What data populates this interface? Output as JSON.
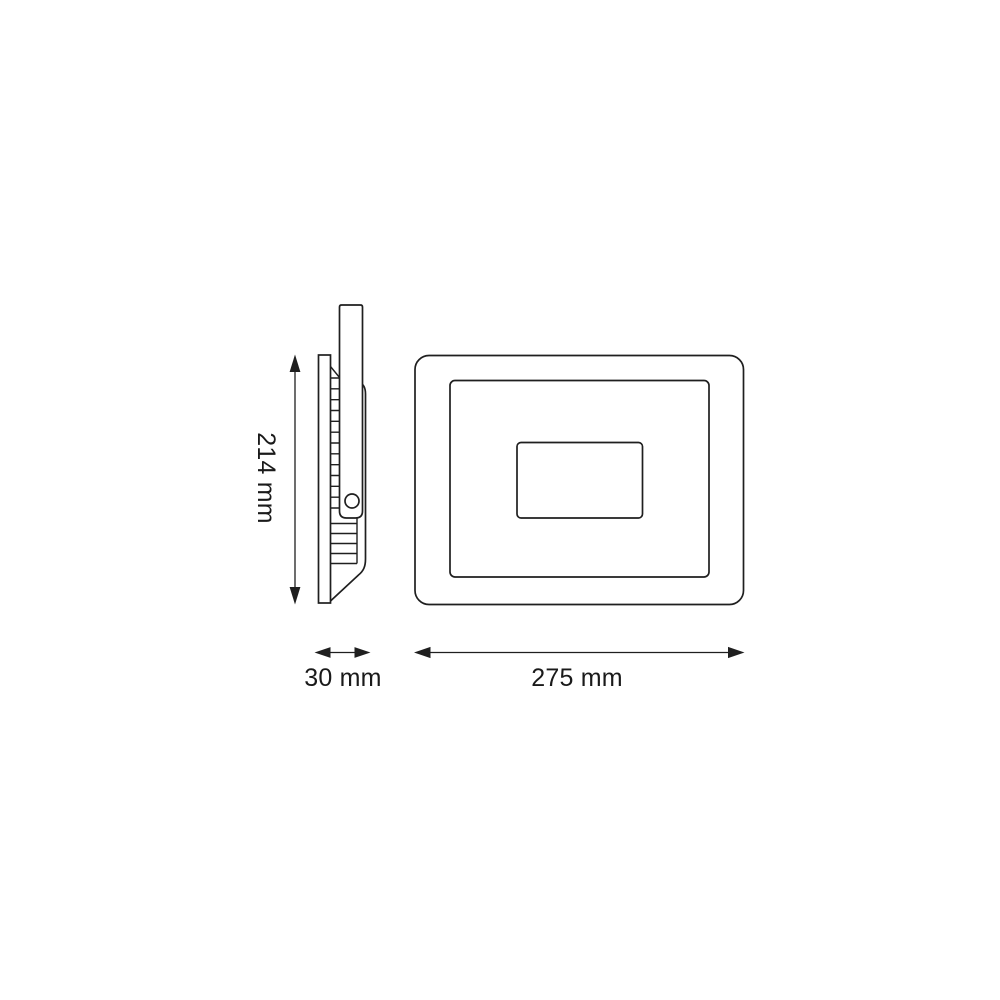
{
  "colors": {
    "background": "#ffffff",
    "line": "#1f1f1f",
    "text": "#1a1a1a"
  },
  "dimensions": {
    "height": {
      "label": "214 mm",
      "value": 214,
      "unit": "mm"
    },
    "depth": {
      "label": "30 mm",
      "value": 30,
      "unit": "mm"
    },
    "width": {
      "label": "275 mm",
      "value": 275,
      "unit": "mm"
    }
  }
}
